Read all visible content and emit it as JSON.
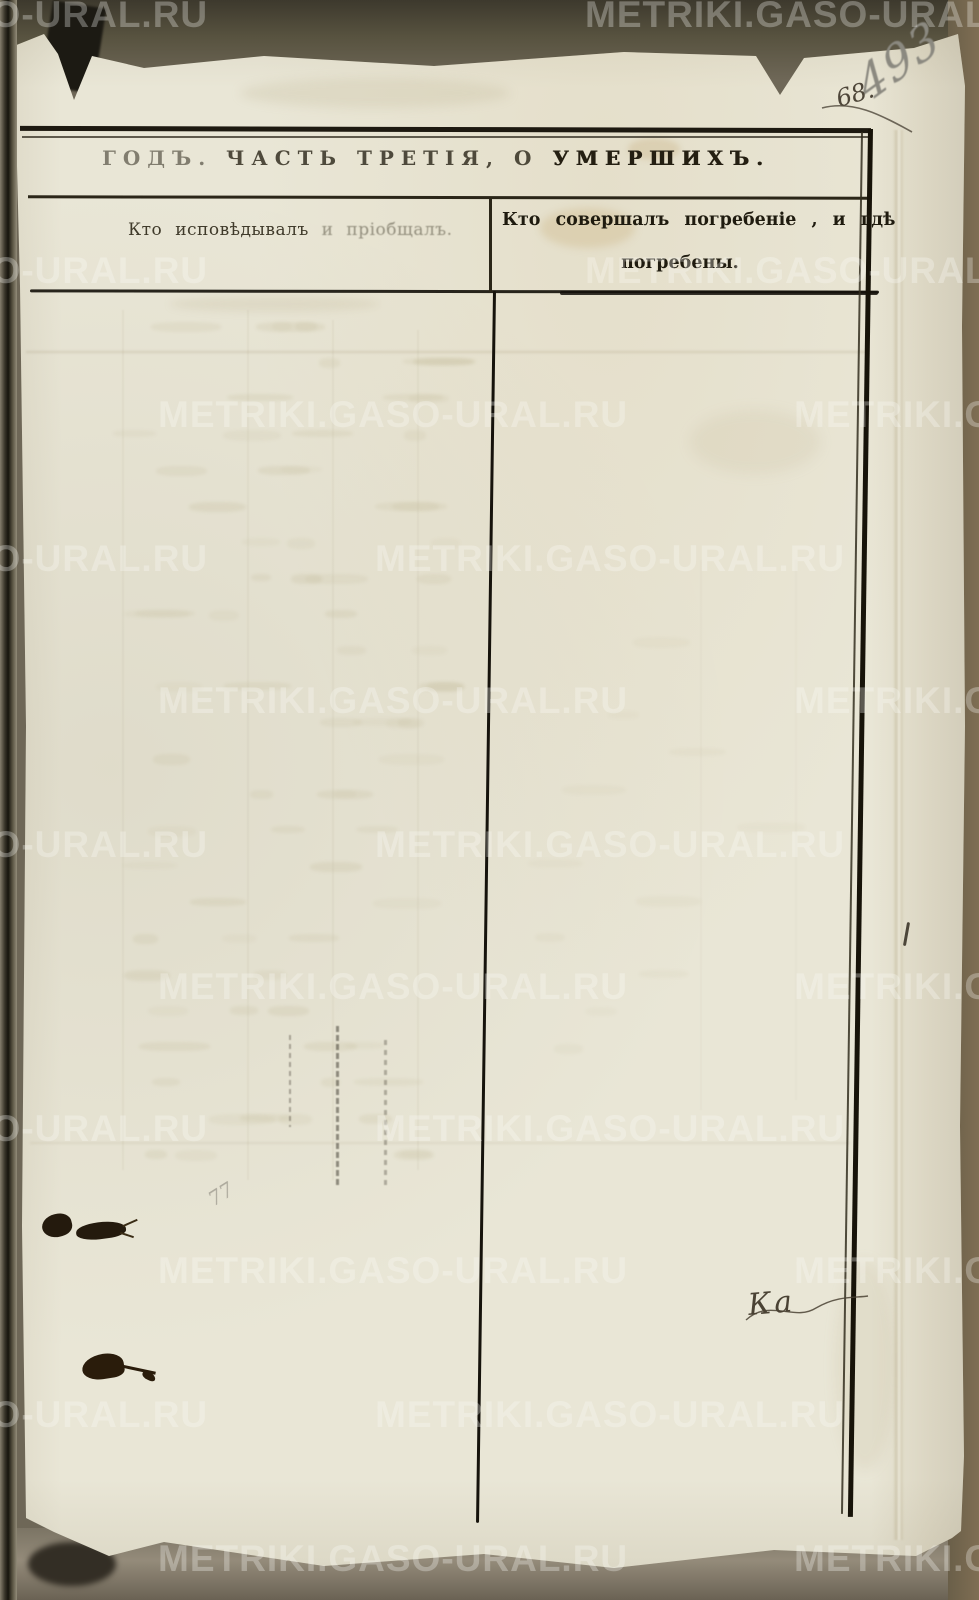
{
  "document": {
    "title": {
      "t1": "ГОДЪ.",
      "t2": "ЧАСТЬ ТРЕТІЯ, О",
      "t3": "УМЕРШИХЪ."
    },
    "columns": {
      "left_header_1": "Кто исповѣдывалъ",
      "left_header_2": " и пріобщалъ.",
      "right_header_line1": "Кто совершалъ погребеніе , и гдѣ",
      "right_header_line2": "погребены."
    },
    "handwriting": {
      "page_number_pencil": "493",
      "page_number_ink": "68.",
      "clerk_mark": "Ка",
      "small_pencil_mark": "77"
    },
    "watermark": {
      "text": "METRIKI.GASO-URAL.RU"
    },
    "colors": {
      "paper": "#e9e6d6",
      "ink": "#1c1810",
      "pencil": "#8b8980",
      "background": "#6e6757",
      "watermark": "rgba(253,253,248,0.30)"
    }
  }
}
